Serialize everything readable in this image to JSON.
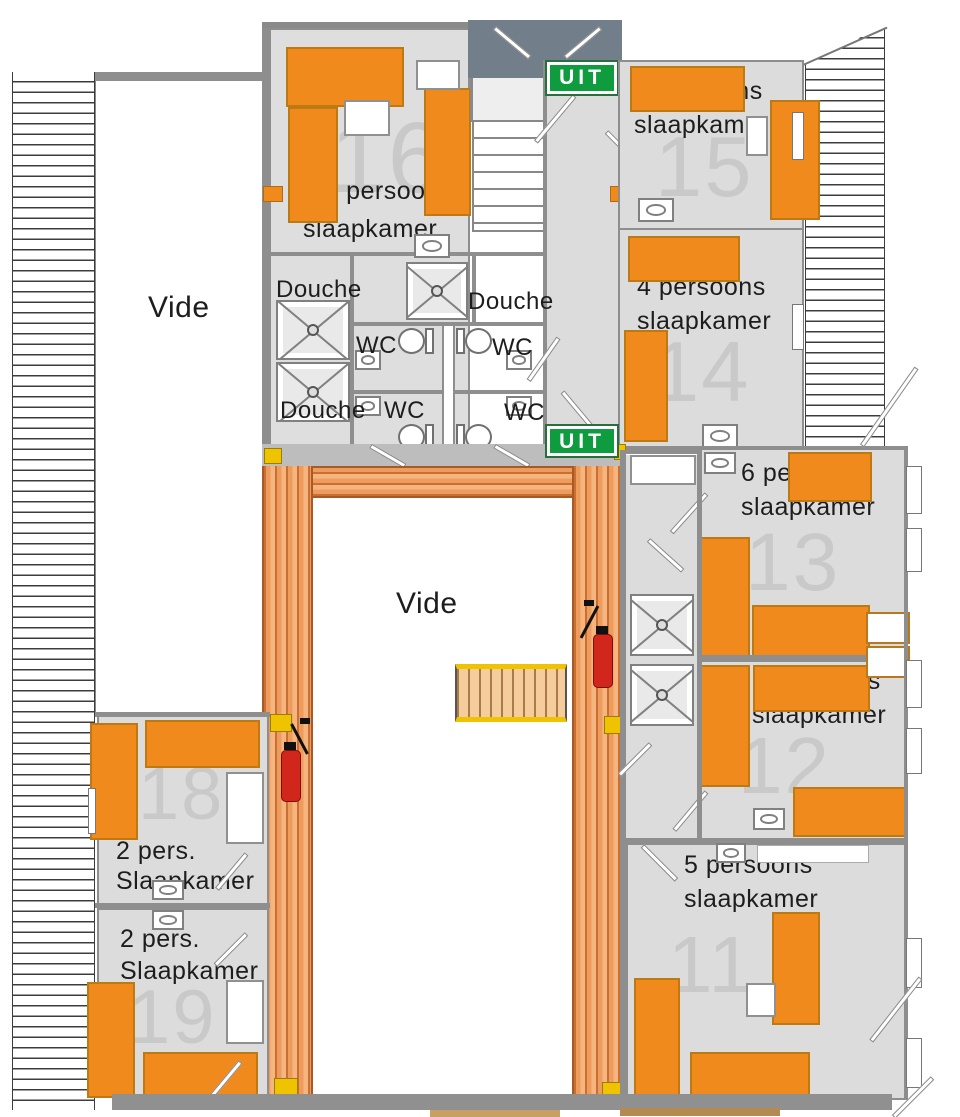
{
  "title": "Verdieping plattegrond (floor plan)",
  "colors": {
    "bed_orange": "#F08A1D",
    "walkway_orange": "#EE9C5D",
    "exit_green": "#0E9C3F",
    "marker_yellow": "#F0C300",
    "extinguisher_red": "#D1261B"
  },
  "rooms": [
    {
      "number": "16",
      "line1": "2-5 persoons",
      "line2": "slaapkamer"
    },
    {
      "number": "15",
      "line1": "2 persoons",
      "line2": "slaapkamer"
    },
    {
      "number": "14",
      "line1": "4 persoons",
      "line2": "slaapkamer"
    },
    {
      "number": "13",
      "line1": "6 persoons",
      "line2": "slaapkamer"
    },
    {
      "number": "12",
      "line1": "6 persoons",
      "line2": "slaapkamer"
    },
    {
      "number": "11",
      "line1": "5 persoons",
      "line2": "slaapkamer"
    },
    {
      "number": "18",
      "line1": "2 pers.",
      "line2": "Slaapkamer"
    },
    {
      "number": "19",
      "line1": "2 pers.",
      "line2": "Slaapkamer"
    }
  ],
  "voids": {
    "left": "Vide",
    "center": "Vide"
  },
  "bathroom": {
    "douche1": "Douche",
    "douche2": "Douche",
    "douche3": "Douche",
    "wc1": "WC",
    "wc2": "WC",
    "wc3": "WC",
    "wc4": "WC"
  },
  "exits": {
    "uit1": "UIT",
    "uit2": "UIT"
  }
}
